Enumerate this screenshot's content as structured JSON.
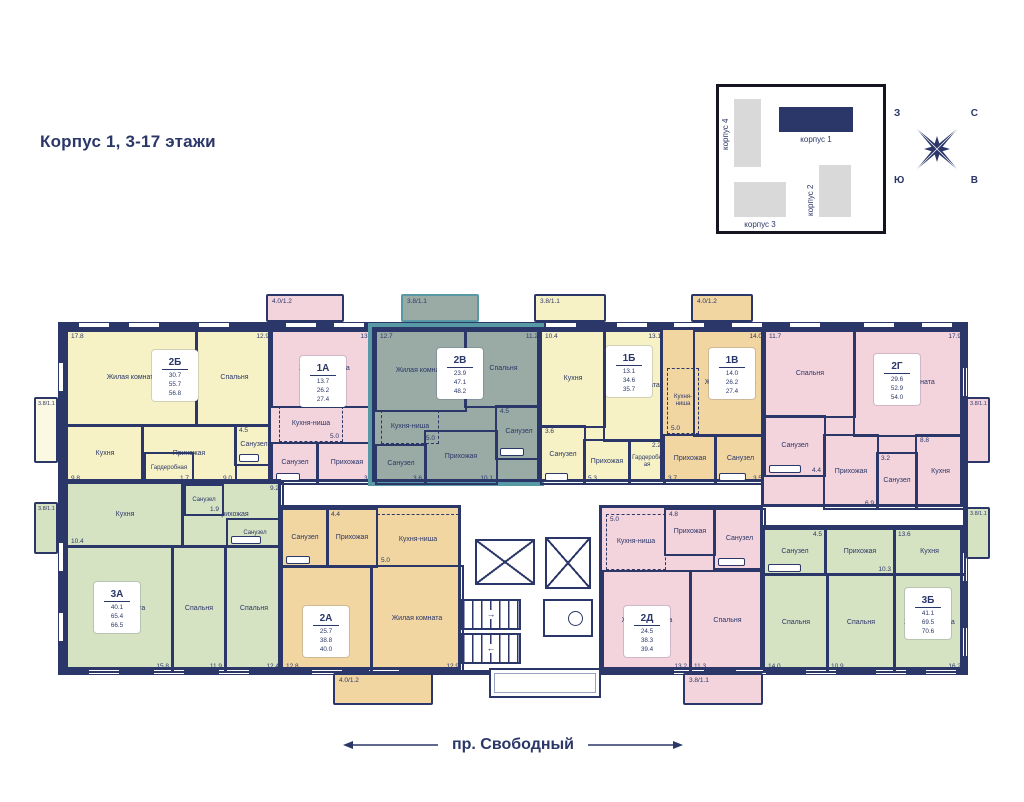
{
  "page": {
    "title": "Корпус 1, 3-17 этажи"
  },
  "street": {
    "label": "пр. Свободный"
  },
  "compass": {
    "west": "З",
    "north": "С",
    "south": "Ю",
    "east": "В"
  },
  "minimap": {
    "buildings": [
      {
        "name": "корпус 4"
      },
      {
        "name": "корпус 1"
      },
      {
        "name": "корпус 2"
      },
      {
        "name": "корпус 3"
      }
    ]
  },
  "colors": {
    "wall": "#2b3768",
    "yellow": "#f7f2c6",
    "pink": "#f3d3dc",
    "orange": "#f2d6a2",
    "green": "#d6e3c3",
    "highlight_teal": "#5799a5",
    "teal_fill": "#9aaba6"
  },
  "apartments": [
    {
      "label": "2Б",
      "area_living": "30.7",
      "area_total": "55.7",
      "area_with_balcony": "56.8",
      "rooms": [
        {
          "name": "Жилая комната",
          "area": "17.8"
        },
        {
          "name": "Спальня",
          "area": "12.9"
        },
        {
          "name": "Кухня",
          "area": "9.8"
        },
        {
          "name": "Прихожая",
          "area": "9.0"
        },
        {
          "name": "Санузел",
          "area": "4.5"
        },
        {
          "name": "Гардеробная",
          "area": "1.7"
        }
      ]
    },
    {
      "label": "1А",
      "area_living": "13.7",
      "area_total": "26.2",
      "area_with_balcony": "27.4",
      "rooms": [
        {
          "name": "Жилая комната",
          "area": "13.7"
        },
        {
          "name": "Кухня-ниша",
          "area": "5.0"
        },
        {
          "name": "Санузел",
          "area": "3.6"
        },
        {
          "name": "Прихожая",
          "area": "3.9"
        }
      ]
    },
    {
      "label": "2В",
      "area_living": "23.9",
      "area_total": "47.1",
      "area_with_balcony": "48.2",
      "rooms": [
        {
          "name": "Жилая комната",
          "area": "12.7"
        },
        {
          "name": "Спальня",
          "area": "11.2"
        },
        {
          "name": "Кухня-ниша",
          "area": "5.0"
        },
        {
          "name": "Санузел",
          "area": "3.6"
        },
        {
          "name": "Прихожая",
          "area": "10.1"
        },
        {
          "name": "Санузел",
          "area": "4.5"
        }
      ]
    },
    {
      "label": "1Б",
      "area_living": "13.1",
      "area_total": "34.6",
      "area_with_balcony": "35.7",
      "rooms": [
        {
          "name": "Кухня",
          "area": "10.4"
        },
        {
          "name": "Жилая комната",
          "area": "13.1"
        },
        {
          "name": "Санузел",
          "area": "3.6"
        },
        {
          "name": "Прихожая",
          "area": "5.3"
        },
        {
          "name": "Гардеробная",
          "area": "2.2"
        }
      ]
    },
    {
      "label": "1В",
      "area_living": "14.0",
      "area_total": "26.2",
      "area_with_balcony": "27.4",
      "rooms": [
        {
          "name": "Жилая комната",
          "area": "14.0"
        },
        {
          "name": "Кухня-ниша",
          "area": "5.0"
        },
        {
          "name": "Прихожая",
          "area": "3.7"
        },
        {
          "name": "Санузел",
          "area": "3.5"
        }
      ]
    },
    {
      "label": "2Г",
      "area_living": "29.6",
      "area_total": "52.9",
      "area_with_balcony": "54.0",
      "rooms": [
        {
          "name": "Спальня",
          "area": "11.7"
        },
        {
          "name": "Жилая комната",
          "area": "17.9"
        },
        {
          "name": "Санузел",
          "area": "4.4"
        },
        {
          "name": "Прихожая",
          "area": "6.9"
        },
        {
          "name": "Санузел",
          "area": "3.2"
        },
        {
          "name": "Кухня",
          "area": "8.8"
        }
      ]
    },
    {
      "label": "3А",
      "area_living": "40.1",
      "area_total": "65.4",
      "area_with_balcony": "66.5",
      "rooms": [
        {
          "name": "Кухня",
          "area": "10.4"
        },
        {
          "name": "Прихожая",
          "area": "9.2"
        },
        {
          "name": "Санузел",
          "area": "1.9"
        },
        {
          "name": "Санузел",
          "area": "3.8"
        },
        {
          "name": "Жилая комната",
          "area": "15.8"
        },
        {
          "name": "Спальня",
          "area": "11.9"
        },
        {
          "name": "Спальня",
          "area": "12.4"
        }
      ]
    },
    {
      "label": "2А",
      "area_living": "25.7",
      "area_total": "38.8",
      "area_with_balcony": "40.0",
      "rooms": [
        {
          "name": "Санузел",
          "area": "3.7"
        },
        {
          "name": "Прихожая",
          "area": "4.4"
        },
        {
          "name": "Кухня-ниша",
          "area": "5.0"
        },
        {
          "name": "Спальня",
          "area": "12.8"
        },
        {
          "name": "Жилая комната",
          "area": "12.9"
        }
      ]
    },
    {
      "label": "2Д",
      "area_living": "24.5",
      "area_total": "38.3",
      "area_with_balcony": "39.4",
      "rooms": [
        {
          "name": "Кухня-ниша",
          "area": "5.0"
        },
        {
          "name": "Прихожая",
          "area": "4.8"
        },
        {
          "name": "Санузел",
          "area": "4.0"
        },
        {
          "name": "Жилая комната",
          "area": "13.2"
        },
        {
          "name": "Спальня",
          "area": "11.3"
        }
      ]
    },
    {
      "label": "3Б",
      "area_living": "41.1",
      "area_total": "69.5",
      "area_with_balcony": "70.6",
      "rooms": [
        {
          "name": "Санузел",
          "area": "4.5"
        },
        {
          "name": "Прихожая",
          "area": "10.3"
        },
        {
          "name": "Кухня",
          "area": "13.6"
        },
        {
          "name": "Спальня",
          "area": "14.0"
        },
        {
          "name": "Спальня",
          "area": "10.9"
        },
        {
          "name": "Жилая комната",
          "area": "16.2"
        }
      ]
    }
  ],
  "balconies": {
    "top": [
      {
        "label": "4.0/1.2"
      },
      {
        "label": "3.8/1.1"
      },
      {
        "label": "3.8/1.1"
      },
      {
        "label": "4.0/1.2"
      }
    ],
    "bottom": [
      {
        "label": "4.0/1.2"
      },
      {
        "label": "3.8/1.1"
      }
    ],
    "left": [
      {
        "label": "3.8/1.1"
      },
      {
        "label": "3.8/1.1"
      }
    ],
    "right": [
      {
        "label": "3.8/1.1"
      },
      {
        "label": "3.8/1.1"
      }
    ]
  }
}
